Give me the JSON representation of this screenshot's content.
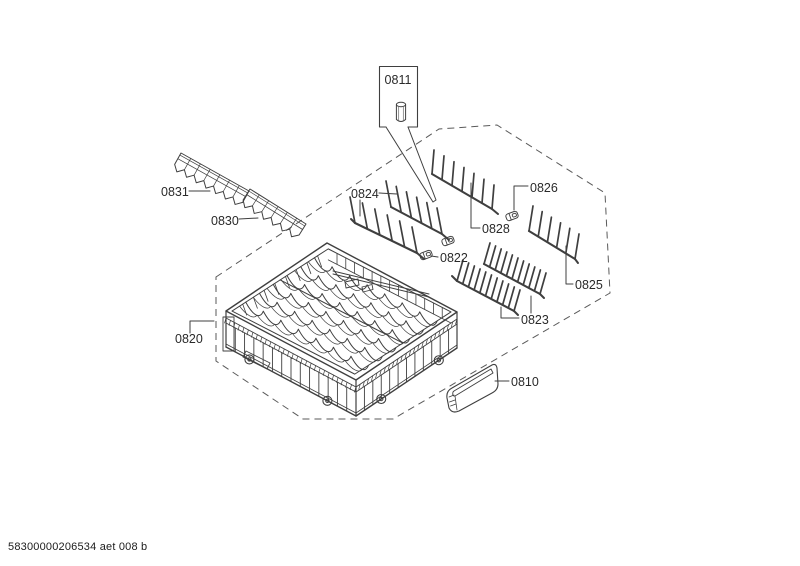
{
  "document": {
    "footer_code": "58300000206534 aet 008 b"
  },
  "colors": {
    "line": "#3f3f3f",
    "boundary": "#5a5a5a",
    "label_text": "#2a2a2a",
    "background": "#ffffff"
  },
  "figure": {
    "type": "exploded-parts-diagram",
    "parts": {
      "0811": {
        "label": "0811"
      },
      "0831": {
        "label": "0831"
      },
      "0830": {
        "label": "0830"
      },
      "0824": {
        "label": "0824"
      },
      "0822": {
        "label": "0822"
      },
      "0828": {
        "label": "0828"
      },
      "0826": {
        "label": "0826"
      },
      "0825": {
        "label": "0825"
      },
      "0823": {
        "label": "0823"
      },
      "0820": {
        "label": "0820"
      },
      "0810": {
        "label": "0810"
      }
    },
    "boundary": {
      "points": [
        [
          216,
          277
        ],
        [
          439,
          129
        ],
        [
          497,
          125
        ],
        [
          605,
          193
        ],
        [
          610,
          293
        ],
        [
          393,
          419
        ],
        [
          303,
          419
        ],
        [
          216,
          361
        ]
      ],
      "dash": [
        7,
        5
      ]
    },
    "callout_wedge": [
      [
        386,
        127
      ],
      [
        433,
        202
      ],
      [
        436,
        200
      ],
      [
        408,
        127
      ]
    ],
    "leaders": [
      [
        [
          189,
          191
        ],
        [
          210,
          191
        ]
      ],
      [
        [
          239,
          219
        ],
        [
          258,
          218
        ]
      ],
      [
        [
          379,
          193
        ],
        [
          397,
          194
        ]
      ],
      [
        [
          360,
          200
        ],
        [
          360,
          216
        ]
      ],
      [
        [
          480,
          228
        ],
        [
          471,
          228
        ],
        [
          471,
          183
        ]
      ],
      [
        [
          528,
          186
        ],
        [
          514,
          186
        ],
        [
          514,
          210
        ]
      ],
      [
        [
          438,
          257
        ],
        [
          431,
          256
        ]
      ],
      [
        [
          573,
          284
        ],
        [
          566,
          284
        ],
        [
          566,
          246
        ]
      ],
      [
        [
          519,
          318
        ],
        [
          501,
          318
        ],
        [
          501,
          307
        ]
      ],
      [
        [
          531,
          313
        ],
        [
          531,
          296
        ]
      ],
      [
        [
          190,
          333
        ],
        [
          190,
          321
        ],
        [
          214,
          321
        ]
      ],
      [
        [
          509,
          381
        ],
        [
          495,
          381
        ]
      ]
    ],
    "tine_rows": [
      {
        "part": "0824",
        "base": [
          355,
          223,
          417,
          253
        ],
        "n": 6,
        "tine": [
          -5,
          -26
        ],
        "start": [
          -4,
          -4
        ],
        "end": [
          7,
          6
        ]
      },
      {
        "part": "0824",
        "base": [
          391,
          207,
          442,
          234
        ],
        "n": 6,
        "tine": [
          -5,
          -26
        ],
        "end": [
          7,
          6
        ]
      },
      {
        "part": "0828",
        "base": [
          432,
          174,
          492,
          209
        ],
        "n": 7,
        "tine": [
          2,
          -24
        ],
        "end": [
          6,
          5
        ]
      },
      {
        "part": "0825",
        "base": [
          529,
          231,
          575,
          259
        ],
        "n": 6,
        "tine": [
          4,
          -25
        ],
        "end": [
          3,
          4
        ]
      },
      {
        "part": "0823",
        "base": [
          484,
          264,
          540,
          294
        ],
        "n": 11,
        "tine": [
          6,
          -21
        ],
        "end": [
          4,
          4
        ]
      },
      {
        "part": "0823",
        "base": [
          457,
          281,
          514,
          311
        ],
        "n": 11,
        "tine": [
          6,
          -21
        ],
        "start": [
          -5,
          -5
        ],
        "end": [
          4,
          4
        ]
      }
    ],
    "clips": [
      {
        "part": "0822",
        "c": [
          426,
          255
        ],
        "r": -20
      },
      {
        "part": "0822",
        "c": [
          448,
          241
        ],
        "r": -20
      },
      {
        "part": "0826",
        "c": [
          512,
          216
        ],
        "r": -20
      }
    ],
    "strips": [
      {
        "part": "0831",
        "a": [
          181,
          153
        ],
        "b": [
          249,
          191
        ],
        "teeth": 7
      },
      {
        "part": "0830",
        "a": [
          250,
          189
        ],
        "b": [
          306,
          224
        ],
        "teeth": 6
      }
    ],
    "basket": {
      "part": "0820",
      "L": [
        226,
        311
      ],
      "T": [
        327,
        243
      ],
      "R": [
        457,
        312
      ],
      "F": [
        356,
        380
      ],
      "depth": 36
    }
  }
}
